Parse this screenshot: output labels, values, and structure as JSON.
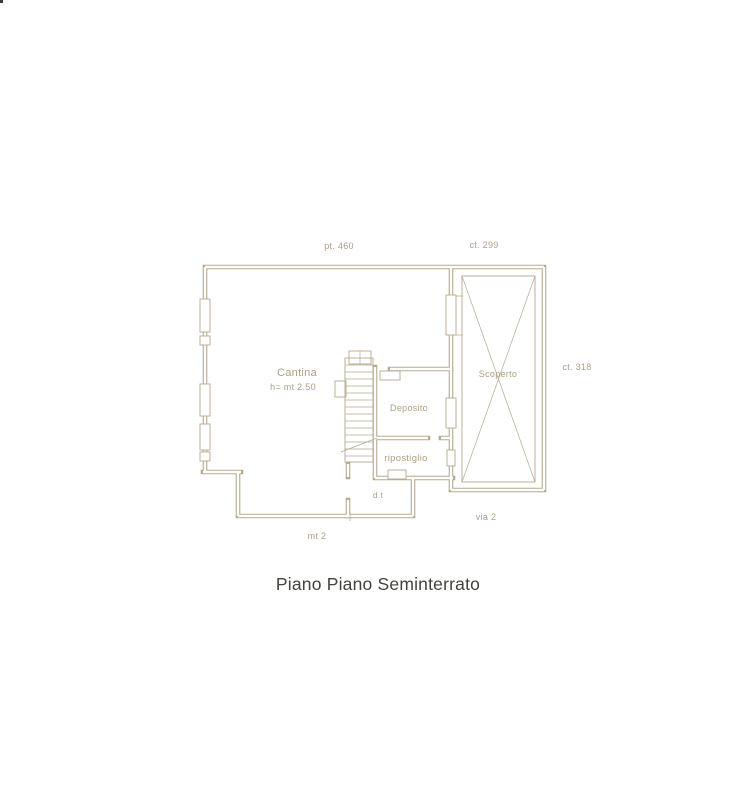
{
  "colors": {
    "background": "#ffffff",
    "line": "#b6aa90",
    "label": "#ab9f85",
    "caption": "#44423c"
  },
  "caption": {
    "text": "Piano Piano Seminterrato"
  },
  "plan": {
    "rooms": {
      "cantina": {
        "label": "Cantina",
        "height": "h= mt 2.50"
      },
      "deposito": {
        "label": "Deposito"
      },
      "ripostiglio": {
        "label": "ripostiglio"
      },
      "scoperto": {
        "label": "Scoperto"
      },
      "dt": {
        "label": "d.t"
      }
    },
    "dimensions": {
      "top_left": "pt. 460",
      "top_right": "ct. 299",
      "right": "ct. 318",
      "bottom_right": "via 2",
      "bottom_left": "mt 2"
    }
  }
}
